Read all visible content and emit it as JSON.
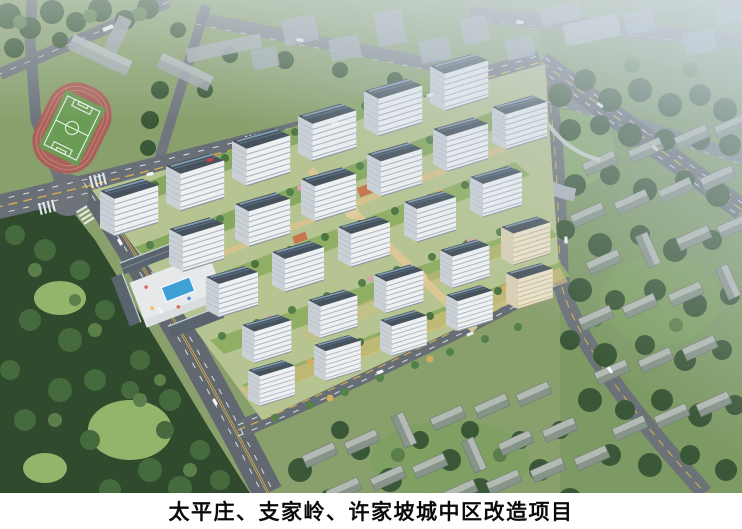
{
  "caption": {
    "title": "太平庄、支家岭、许家坡城中区改造项目"
  },
  "scene": {
    "type": "aerial-architectural-rendering",
    "features": [
      "new high-rise residential complex with landscaped green courtyards",
      "school running track with soccer field",
      "outdoor swimming-pool plaza with commercial street roofs",
      "urban road network with intersections, crosswalks and cars",
      "woodland park with lawns",
      "existing low-rise old-town houses among trees",
      "haze over distant city blocks"
    ],
    "palette": {
      "tower_facade": "#edf0f2",
      "tower_roof": "#46525e",
      "cream_facade": "#ebe3ca",
      "road": "#686f76",
      "center_line_yellow": "#d4ad4e",
      "lane_dash_white": "#e8ecef",
      "track_red": "#a9625a",
      "pitch_green": "#6a9c55",
      "pool_blue": "#3fa0d8",
      "tree_dark": "#3a5737",
      "lawn_light": "#93b56b",
      "gold_foliage": "#d2ae62",
      "fog": "#c7d2dd",
      "caption_background": "#ffffff",
      "caption_text": "#0a0a0a"
    }
  }
}
